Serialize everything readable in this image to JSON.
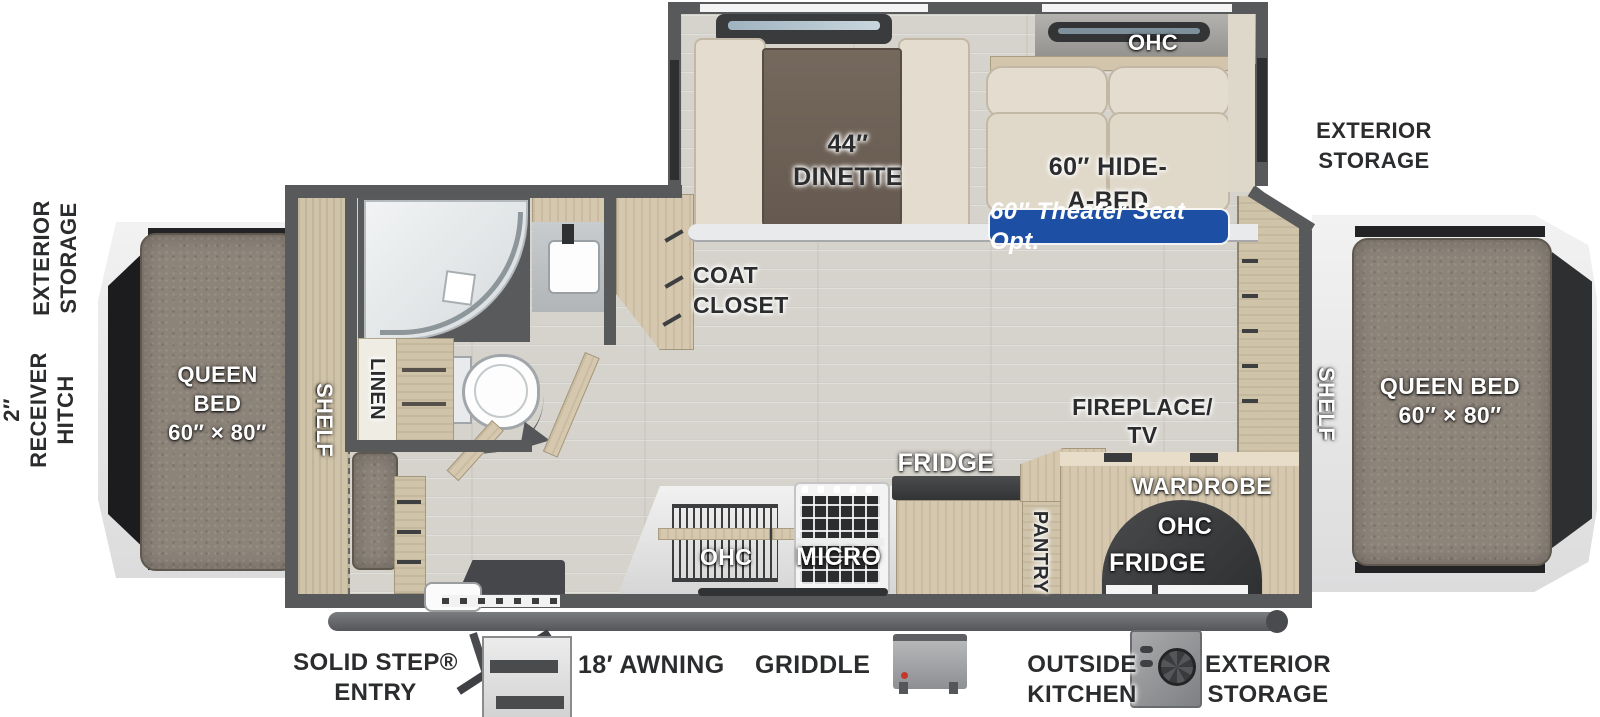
{
  "diagram": {
    "type": "travel-trailer-floorplan",
    "colors": {
      "wall": "#58595b",
      "floor": "#d6d3cc",
      "wood": "#d5c8af",
      "mattress": "#8c8379",
      "cushion": "#e4ddcf",
      "badge_blue": "#1d50a4",
      "table": "#6e6156",
      "label_dark": "#2b2c2e",
      "label_light": "#ffffff"
    }
  },
  "hitch": {
    "l1": "2″",
    "l2": "RECEIVER",
    "l3": "HITCH"
  },
  "front_storage": {
    "l1": "EXTERIOR",
    "l2": "STORAGE"
  },
  "rear_storage_top": {
    "l1": "EXTERIOR",
    "l2": "STORAGE"
  },
  "front_bed": {
    "l1": "QUEEN",
    "l2": "BED",
    "l3": "60″ × 80″"
  },
  "rear_bed": {
    "l1": "QUEEN BED",
    "l2": "60″ × 80″"
  },
  "slide": {
    "ohc": "OHC",
    "dinette_l1": "44″",
    "dinette_l2": "DINETTE",
    "hidabed_l1": "60″ HIDE-",
    "hidabed_l2": "A-BED",
    "badge": "60″ Theater Seat Opt."
  },
  "interior": {
    "front_shelf": "SHELF",
    "rear_shelf": "SHELF",
    "linen": "LINEN",
    "coat_l1": "COAT",
    "coat_l2": "CLOSET",
    "ohc": "OHC",
    "micro": "MICRO",
    "fridge": "FRIDGE",
    "pantry": "PANTRY",
    "fireplace_l1": "FIREPLACE/",
    "fireplace_l2": "TV",
    "wardrobe": "WARDROBE",
    "wardrobe_ohc": "OHC",
    "wardrobe_fridge": "FRIDGE"
  },
  "bottom": {
    "entry_l1": "SOLID STEP®",
    "entry_l2": "ENTRY",
    "awning": "18′ AWNING",
    "griddle": "GRIDDLE",
    "outside_l1": "OUTSIDE",
    "outside_l2": "KITCHEN",
    "storage_l1": "EXTERIOR",
    "storage_l2": "STORAGE"
  }
}
